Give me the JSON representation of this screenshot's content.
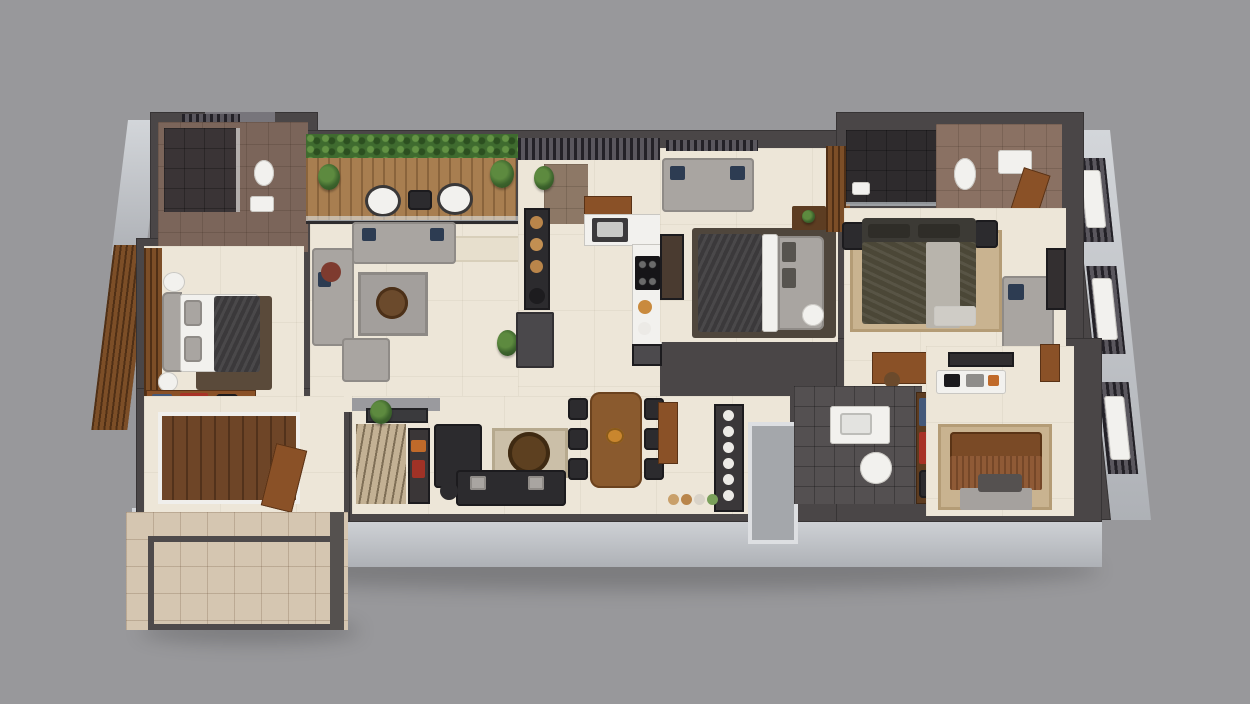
{
  "scene": {
    "type": "3d-floor-plan-render",
    "description": "Isometric 3D rendered floor plan of a 3-bedroom apartment with living room, kitchen, dining, three bathrooms, balcony and entrance porch on a plain gray background. No text labels are visible.",
    "view": "top-down isometric",
    "background_color": "#98989b"
  },
  "palette": {
    "background": "#98989b",
    "wall_dark": "#4a4647",
    "wall_face_light": "#c9ccd1",
    "floor_cream": "#ede6d8",
    "wood": "#8a5127",
    "deck_wood_dark": "#6e4527",
    "balcony_deck": "#a87e50",
    "sofa_gray": "#a9a5a1",
    "black_furniture": "#2c2b2e",
    "navy_pillow": "#2d3c52",
    "olive_bed": "#4b4737",
    "rust_blanket": "#8f5a36",
    "tan_rug": "#c9b390",
    "porch_tile": "#d5c6b1",
    "bathroom_brown_tile": "#87705f",
    "bathroom_dark_tile": "#545051",
    "plant_green": "#4e7a38",
    "accent_red": "#a83226"
  },
  "rooms": [
    {
      "id": "bathroom-1",
      "label": "Bathroom 1 (top-left)",
      "floor": "brown tile",
      "furniture": [
        "shower",
        "toilet",
        "washbasin",
        "slatted-vent"
      ]
    },
    {
      "id": "bedroom-1",
      "label": "Bedroom 1 (left)",
      "floor": "cream marble",
      "furniture": [
        "double-bed-dark-duvet",
        "slatted-wardrobe",
        "round-side-table",
        "lamp-table",
        "dresser-with-red-box-and-clothes"
      ]
    },
    {
      "id": "entrance-foyer",
      "label": "Entrance foyer (bottom-left)",
      "floor": "cream + wood deck",
      "furniture": [
        "wood-deck",
        "open-entry-door"
      ]
    },
    {
      "id": "porch",
      "label": "Open porch / patio (bottom-left)",
      "floor": "beige stone tiles",
      "furniture": [
        "paved-border-frame",
        "corner-post"
      ]
    },
    {
      "id": "balcony",
      "label": "Balcony sit-out (top)",
      "floor": "wood deck",
      "furniture": [
        "hedge-planter",
        "potted-plant-left",
        "potted-plant-right",
        "outdoor-chair-1",
        "outdoor-chair-2",
        "outdoor-side-table",
        "glass-railing"
      ]
    },
    {
      "id": "living-room",
      "label": "Living room",
      "floor": "cream marble",
      "furniture": [
        "l-shaped-sectional-sofa",
        "navy-pillows",
        "armchair",
        "gray-rug",
        "round-wood-coffee-table",
        "red-stool",
        "wood-stool",
        "cream-runner-rug",
        "potted-plant"
      ]
    },
    {
      "id": "kitchen",
      "label": "Kitchen + utility",
      "floor": "cream marble",
      "furniture": [
        "pergola-slats",
        "potted-plant",
        "tall-shelf-with-wooden-jars",
        "black-pot",
        "refrigerator",
        "spice-cabinet",
        "sink-counter",
        "l-shaped-island-counter",
        "gas-hob"
      ]
    },
    {
      "id": "bedroom-2",
      "label": "Bedroom 2 (middle)",
      "floor": "cream marble",
      "furniture": [
        "window",
        "three-seat-gray-sofa",
        "navy-pillows",
        "console-shelf",
        "double-bed-dark-duvet",
        "gray-headboard",
        "nightstand-with-plant",
        "round-lamp-table",
        "wooden-wardrobe"
      ]
    },
    {
      "id": "master-suite",
      "label": "Master bedroom + ensuite (top-right)",
      "floor": "cream marble / brown tile",
      "furniture": [
        "dark-tiled-shower",
        "bath-mat",
        "toilet",
        "washbasin",
        "wooden-door",
        "king-bed-olive",
        "dark-headboard",
        "two-nightstands",
        "bed-runner",
        "foot-bench",
        "tan-rug",
        "corner-sofa",
        "navy-pillow",
        "tv-panel",
        "dressing-table"
      ]
    },
    {
      "id": "lounge-dining",
      "label": "Family lounge + dining (bottom-center)",
      "floor": "cream marble",
      "furniture": [
        "wall-tv-panel",
        "zebra-print-rug",
        "potted-plant",
        "console-with-decor",
        "black-armchair",
        "black-sofa",
        "round-coffee-table",
        "beige-rug",
        "black-stool",
        "wooden-dining-table",
        "six-black-chairs",
        "fruit-bowl",
        "crockery-shelf-with-plates",
        "jar-row",
        "wooden-door"
      ]
    },
    {
      "id": "hallway",
      "label": "Hallway / entry niche",
      "floor": "cream + gray",
      "furniture": [
        "gray-entry-niche"
      ]
    },
    {
      "id": "bathroom-3",
      "label": "Bathroom 3 (bottom-right)",
      "floor": "dark tile",
      "furniture": [
        "vanity-washbasin",
        "toilet",
        "linen-shelf-blue-clothes",
        "red-storage-box",
        "dark-storage-box"
      ]
    },
    {
      "id": "bedroom-3",
      "label": "Bedroom 3 (bottom-right)",
      "floor": "cream marble",
      "furniture": [
        "tv-panel",
        "study-desk-with-laptop",
        "tan-rug",
        "double-bed-rust-blanket",
        "wood-headboard",
        "foot-bench",
        "side-windows",
        "wooden-door"
      ]
    }
  ],
  "facade": {
    "right_windows": 3,
    "style": "light gray extruded walls with dark slatted window shutters"
  }
}
